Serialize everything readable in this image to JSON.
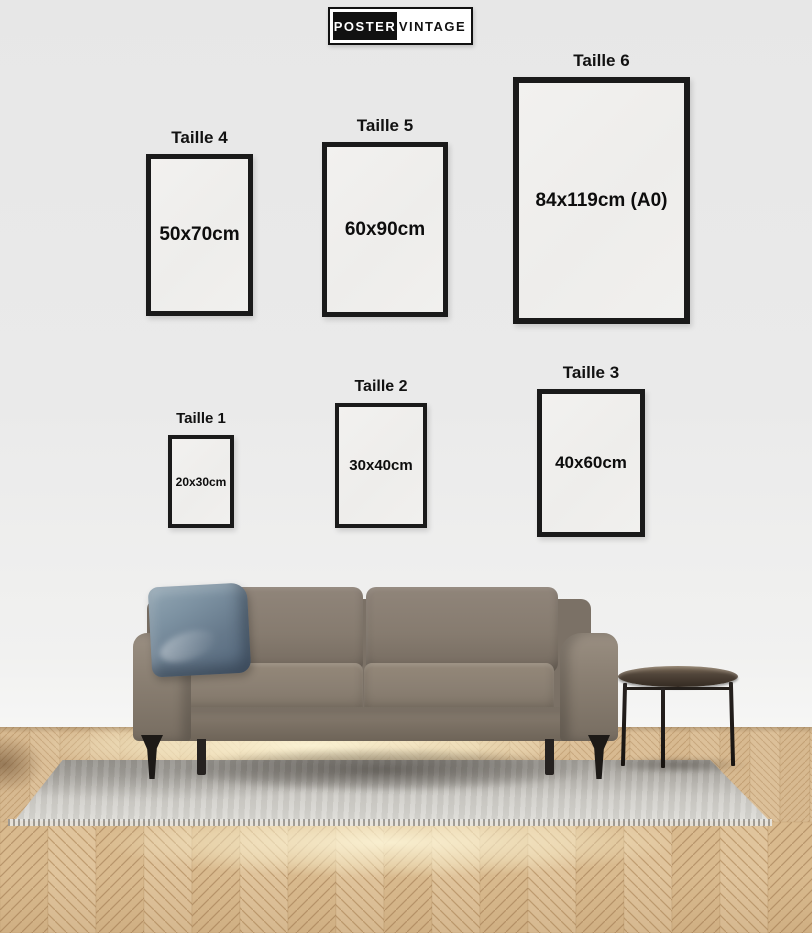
{
  "brand": {
    "poster": "POSTER",
    "vintage": "VINTAGE"
  },
  "frames": [
    {
      "label": "Taille 1",
      "size": "20x30cm"
    },
    {
      "label": "Taille 2",
      "size": "30x40cm"
    },
    {
      "label": "Taille 3",
      "size": "40x60cm"
    },
    {
      "label": "Taille 4",
      "size": "50x70cm"
    },
    {
      "label": "Taille 5",
      "size": "60x90cm"
    },
    {
      "label": "Taille 6",
      "size": "84x119cm (A0)"
    }
  ],
  "colors": {
    "wall": "#eaeaea",
    "frame_border": "#1a1a1a",
    "text": "#111111",
    "logo_black": "#111111",
    "logo_white": "#ffffff",
    "wood": "#d9bc93",
    "wood_seam": "#c3a075",
    "rug": "#d6d5d0",
    "sofa": "#8a7f73",
    "pillow": "#6d8294",
    "table": "#3f352b"
  }
}
